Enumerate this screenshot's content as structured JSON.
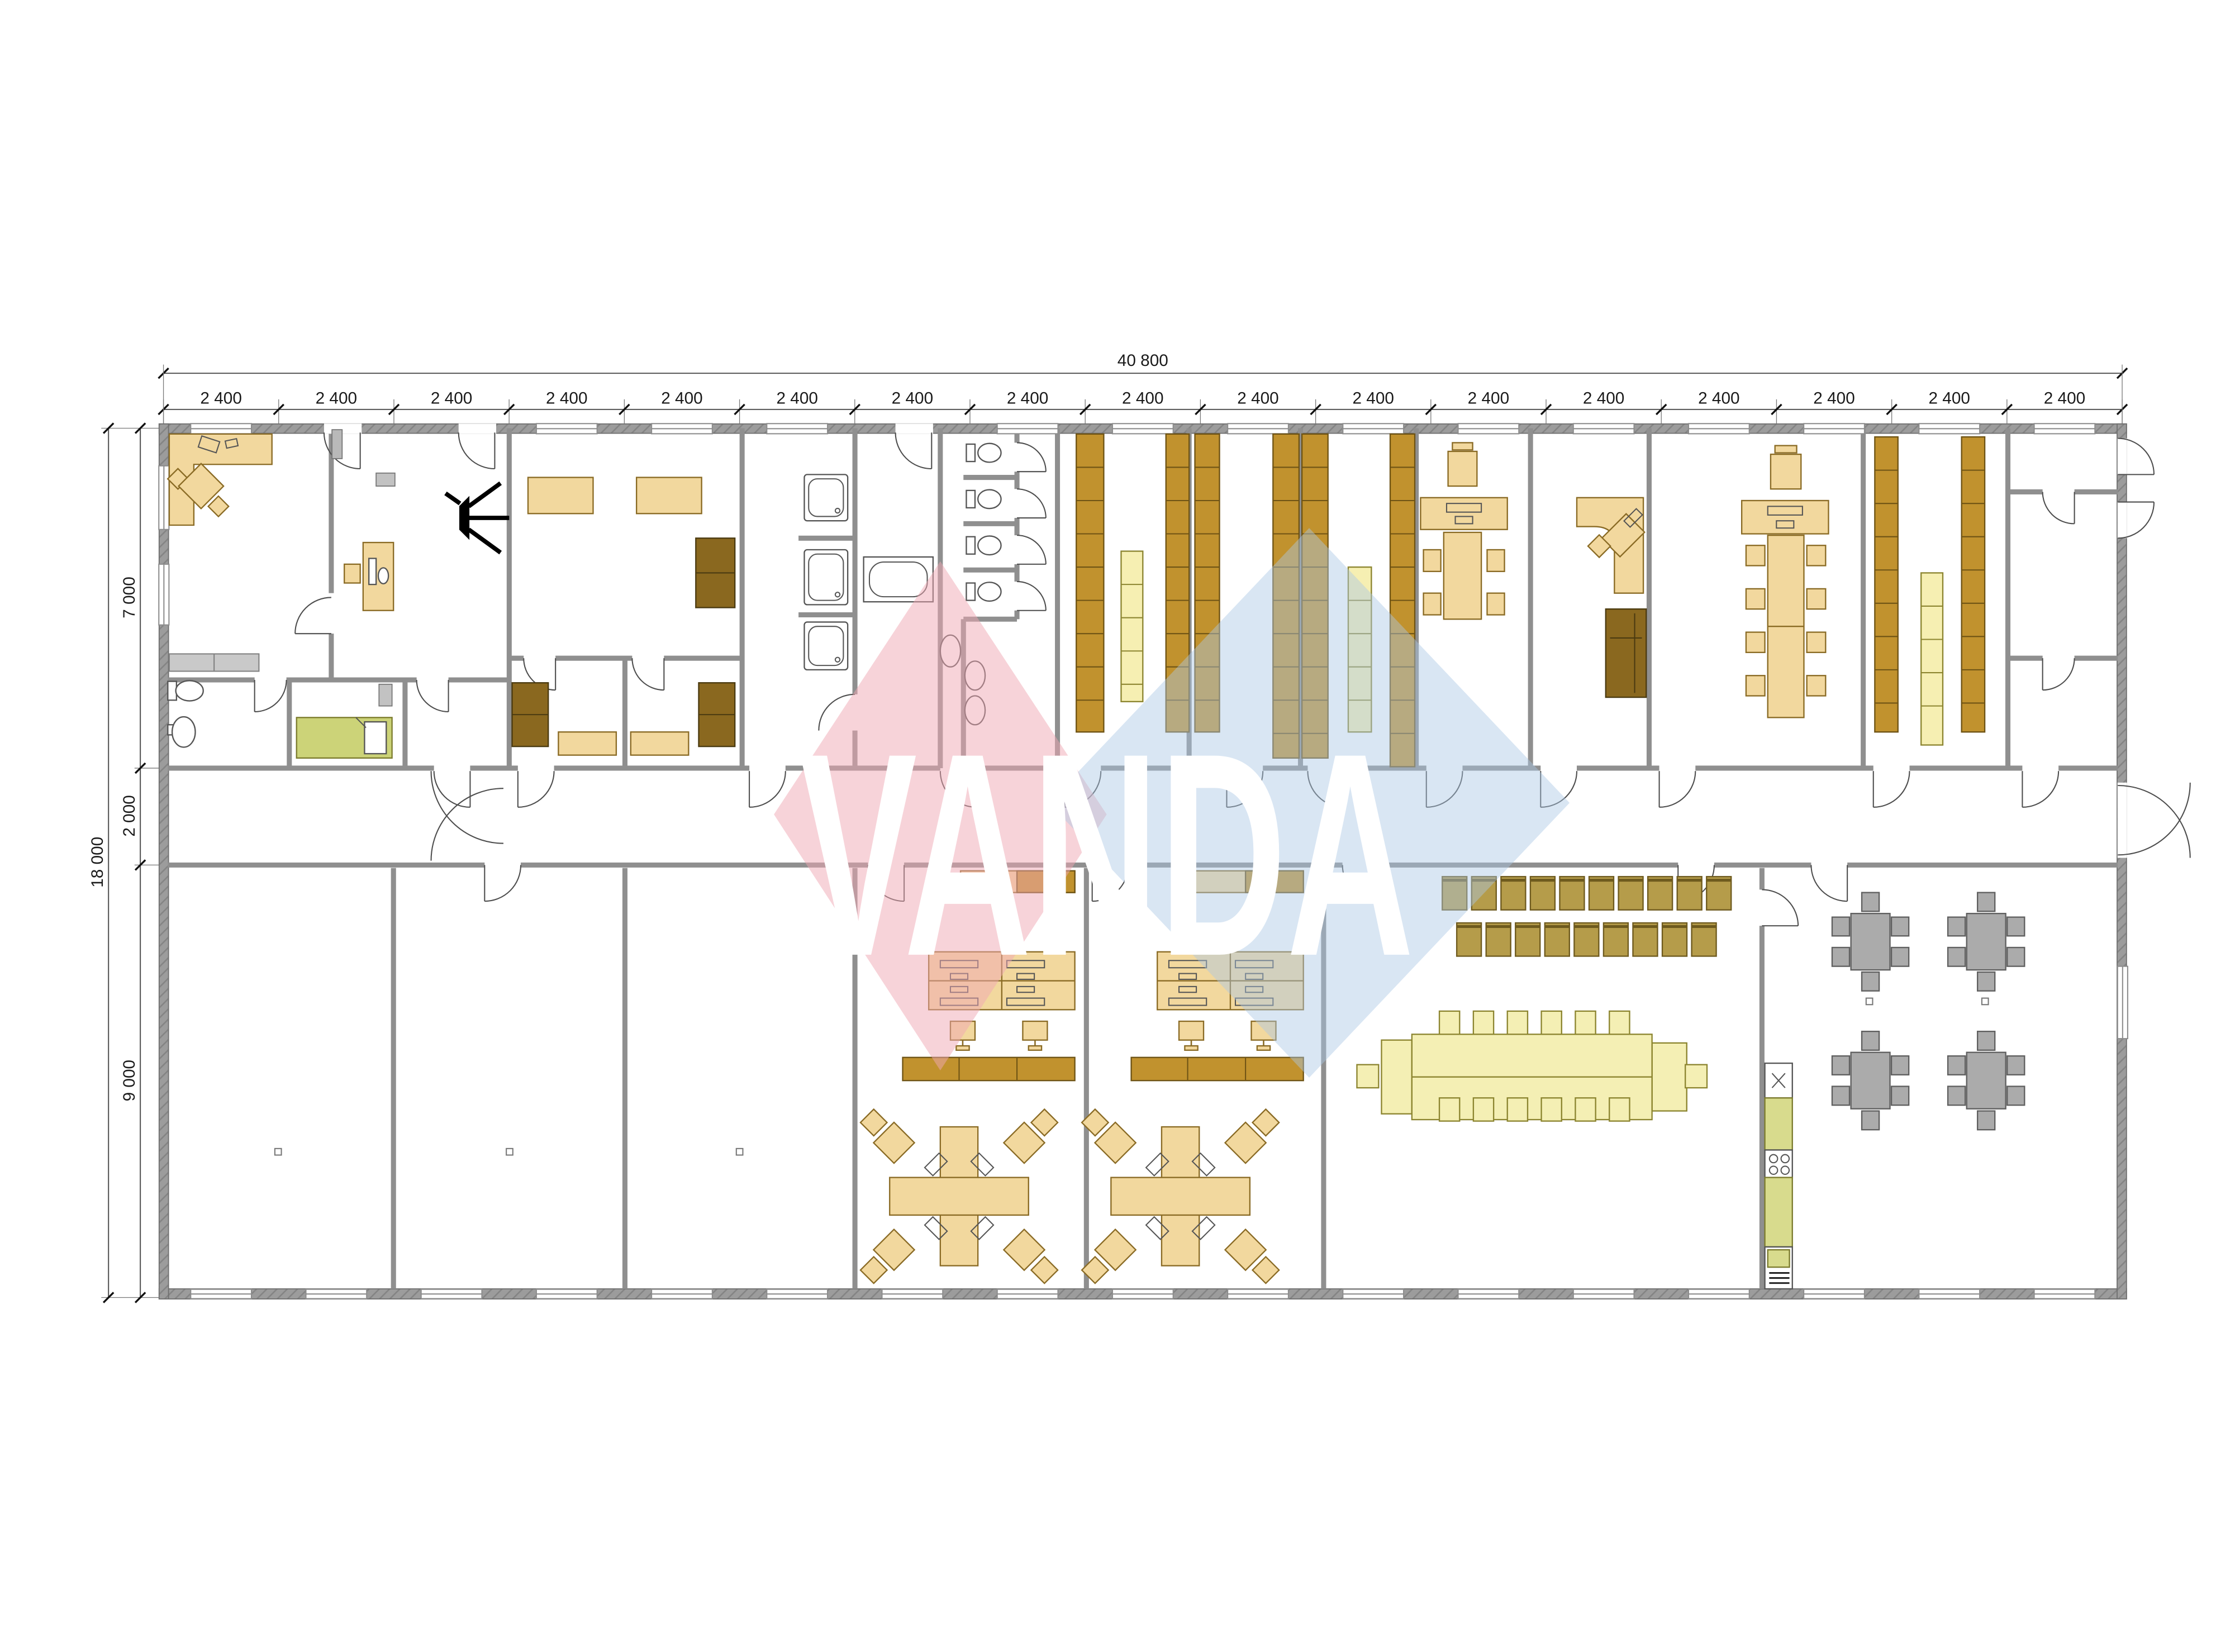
{
  "title": "Modular office building floor plan",
  "watermark": {
    "text": "VANDA"
  },
  "dimensions": {
    "top_total_label": "40 800",
    "top_segments": {
      "label": "2 400",
      "count": 17
    },
    "left": {
      "top_label": "7 000",
      "middle_label": "2 000",
      "bottom_label": "9 000",
      "total_label": "18 000"
    }
  },
  "colors": {
    "wall": "#8f8f8f",
    "tan": "#f2d89e",
    "tanstroke": "#8a6b25",
    "rackbrown": "#c1922e",
    "rackbrownstroke": "#6e5314",
    "cabinetdark": "#8a681f",
    "chairolive": "#b59c4a",
    "tablepale": "#f4efb4",
    "rackyellow": "#f6efb2",
    "grayfurn": "#ababab",
    "grayfurnstroke": "#5f5f5f",
    "kitchengreen": "#d8db8d",
    "bedgreen": "#ccd378",
    "wmpink": "#f0a8b4",
    "wmblue": "#aac8e4",
    "dimtext": "#1a1a1a",
    "doorline": "#4d4d4d"
  },
  "rooms": [
    {
      "name": "reception-office",
      "furniture": "L-shaped desk, 2 chairs, computer workstation"
    },
    {
      "name": "staff-wc",
      "furniture": "toilet, washbasin"
    },
    {
      "name": "rest-room",
      "furniture": "single bed"
    },
    {
      "name": "training-room",
      "furniture": "2 tables, wardrobe"
    },
    {
      "name": "store-room-1",
      "furniture": "cabinet, table"
    },
    {
      "name": "store-room-2",
      "furniture": "cabinet, table"
    },
    {
      "name": "shower-room",
      "furniture": "3 shower cabins"
    },
    {
      "name": "bathroom",
      "furniture": "bathtub"
    },
    {
      "name": "toilet-block",
      "furniture": "4 WC cubicles, 3 washbasins"
    },
    {
      "name": "storage-1",
      "furniture": "shelving racks"
    },
    {
      "name": "storage-2",
      "furniture": "shelving racks"
    },
    {
      "name": "storage-3",
      "furniture": "shelving racks"
    },
    {
      "name": "office-workstation",
      "furniture": "desk with PC, meeting table, 4 chairs, cabinet"
    },
    {
      "name": "manager-office",
      "furniture": "corner desk, chair, sofa"
    },
    {
      "name": "meeting-room",
      "furniture": "long conference table, 8 chairs, desk with PC"
    },
    {
      "name": "storage-4",
      "furniture": "shelving racks"
    },
    {
      "name": "entrance-vestibule",
      "furniture": ""
    },
    {
      "name": "warehouse-1",
      "furniture": ""
    },
    {
      "name": "warehouse-2",
      "furniture": ""
    },
    {
      "name": "warehouse-3",
      "furniture": ""
    },
    {
      "name": "open-office-1",
      "furniture": "4-desk bank with PCs, cross desk island with 4 chairs, cabinets"
    },
    {
      "name": "open-office-2",
      "furniture": "4-desk bank with PCs, cross desk island with 4 chairs, cabinets"
    },
    {
      "name": "conference-hall",
      "furniture": "19 stacking chairs, boardroom table with 14 chairs"
    },
    {
      "name": "kitchen",
      "furniture": "sink, hob, counters, fridge"
    },
    {
      "name": "canteen",
      "furniture": "4 tables, 24 chairs"
    }
  ]
}
